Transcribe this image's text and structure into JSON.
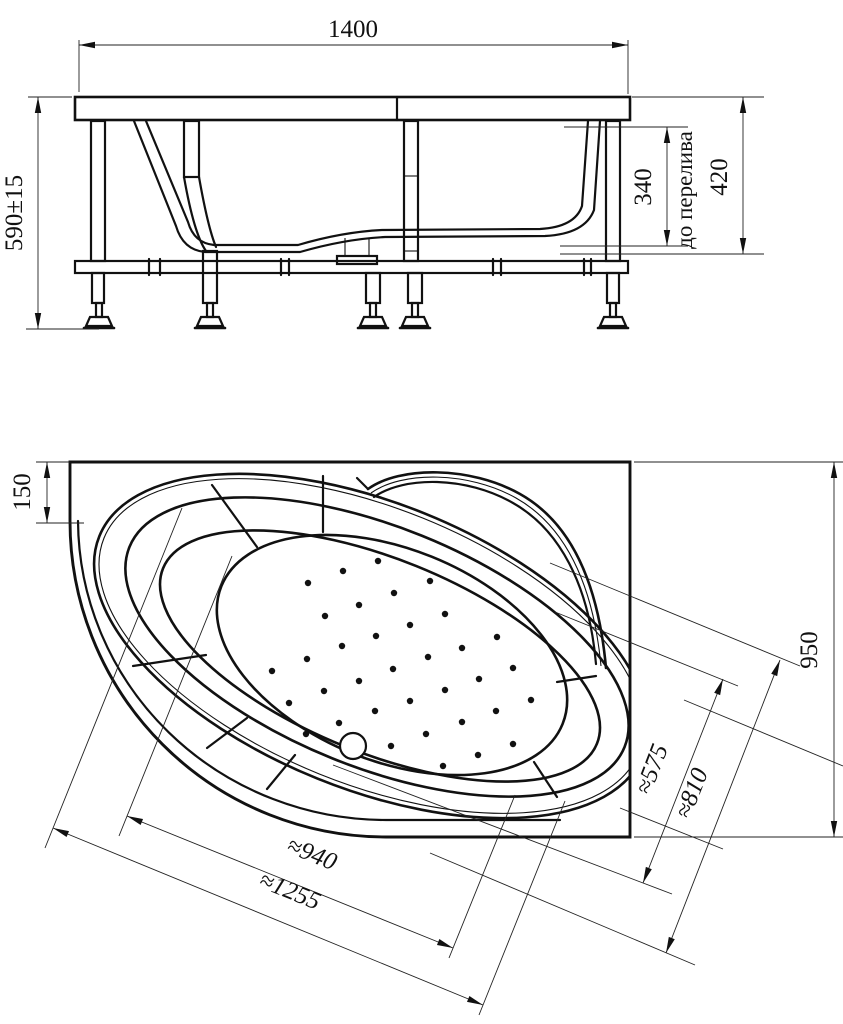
{
  "front_view": {
    "width_label": "1400",
    "height_label": "590±15",
    "overflow_depth_label": "340",
    "overflow_note": "до перелива",
    "total_depth_label": "420"
  },
  "plan_view": {
    "edge_offset_label": "150",
    "side_label": "950",
    "inner_width_label": "≈575",
    "outer_width_label": "≈810",
    "inner_length_label": "≈940",
    "outer_length_label": "≈1255",
    "drain": {
      "cx": 353,
      "cy": 746,
      "r": 13
    },
    "jets": [
      [
        378,
        561
      ],
      [
        343,
        571
      ],
      [
        308,
        583
      ],
      [
        430,
        581
      ],
      [
        394,
        593
      ],
      [
        359,
        605
      ],
      [
        325,
        616
      ],
      [
        445,
        614
      ],
      [
        410,
        625
      ],
      [
        376,
        636
      ],
      [
        342,
        646
      ],
      [
        307,
        659
      ],
      [
        272,
        671
      ],
      [
        497,
        637
      ],
      [
        462,
        648
      ],
      [
        428,
        657
      ],
      [
        393,
        669
      ],
      [
        359,
        681
      ],
      [
        324,
        691
      ],
      [
        289,
        703
      ],
      [
        513,
        668
      ],
      [
        479,
        679
      ],
      [
        445,
        690
      ],
      [
        410,
        701
      ],
      [
        375,
        711
      ],
      [
        339,
        723
      ],
      [
        306,
        734
      ],
      [
        531,
        700
      ],
      [
        496,
        711
      ],
      [
        462,
        722
      ],
      [
        426,
        734
      ],
      [
        391,
        746
      ],
      [
        513,
        744
      ],
      [
        478,
        755
      ],
      [
        443,
        766
      ]
    ]
  },
  "colors": {
    "line": "#111111",
    "background": "#ffffff"
  }
}
